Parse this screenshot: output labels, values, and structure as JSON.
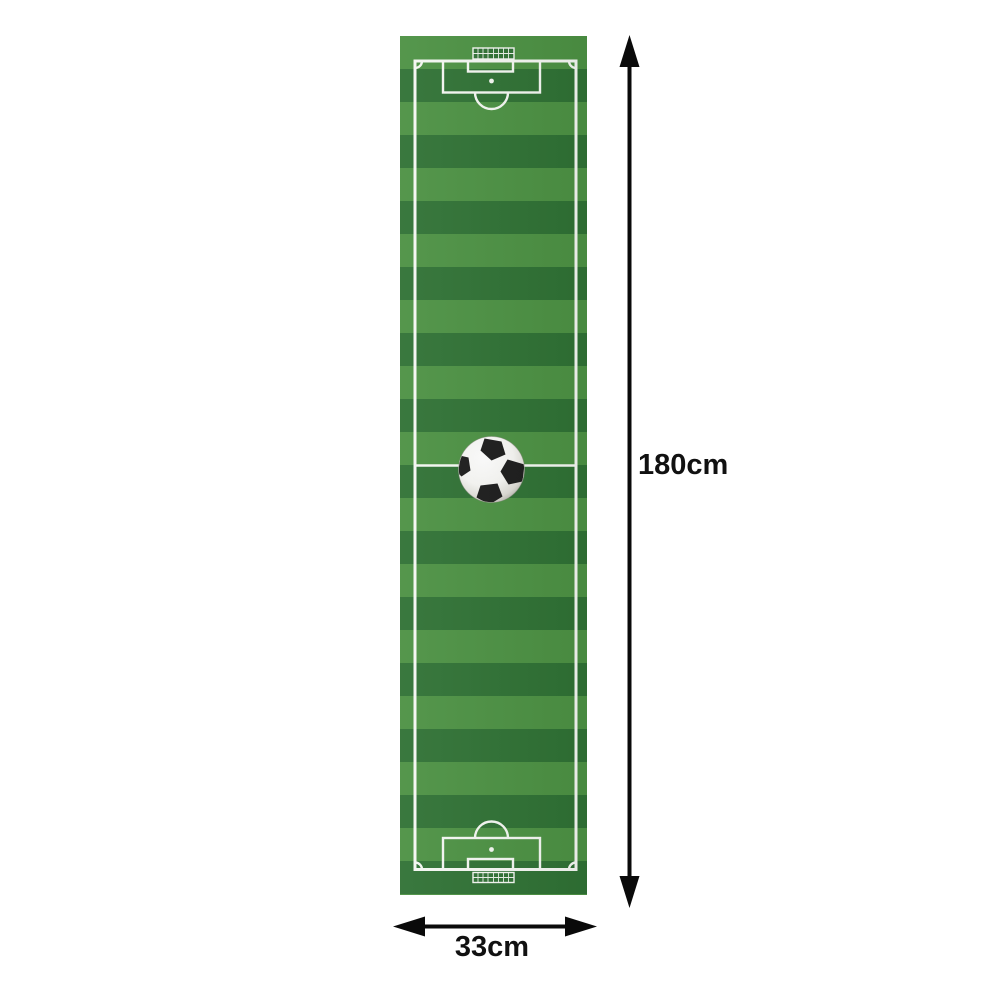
{
  "scene": {
    "description": "soccer-field-rug-dimension-illustration"
  },
  "dimensions": {
    "height_label": "180cm",
    "width_label": "33cm"
  },
  "rug": {
    "kind": "soccer-field-runner-rug",
    "stripe_count": 26,
    "markings": [
      "boundary-line",
      "halfway-line",
      "penalty-box-top",
      "penalty-box-bottom",
      "goal-box-top",
      "goal-box-bottom",
      "penalty-spot-top",
      "penalty-spot-bottom",
      "penalty-arc-top",
      "penalty-arc-bottom",
      "goal-net-top",
      "goal-net-bottom",
      "corner-arcs",
      "soccer-ball"
    ]
  },
  "colors": {
    "background": "#ffffff",
    "stripe_light": "#4c9143",
    "stripe_dark": "#2f7134",
    "field_line": "#f4f7f2",
    "net_fill": "#2f7134",
    "arrow": "#0a0a0a",
    "label_text": "#111111",
    "ball_black": "#1c1c1c"
  }
}
